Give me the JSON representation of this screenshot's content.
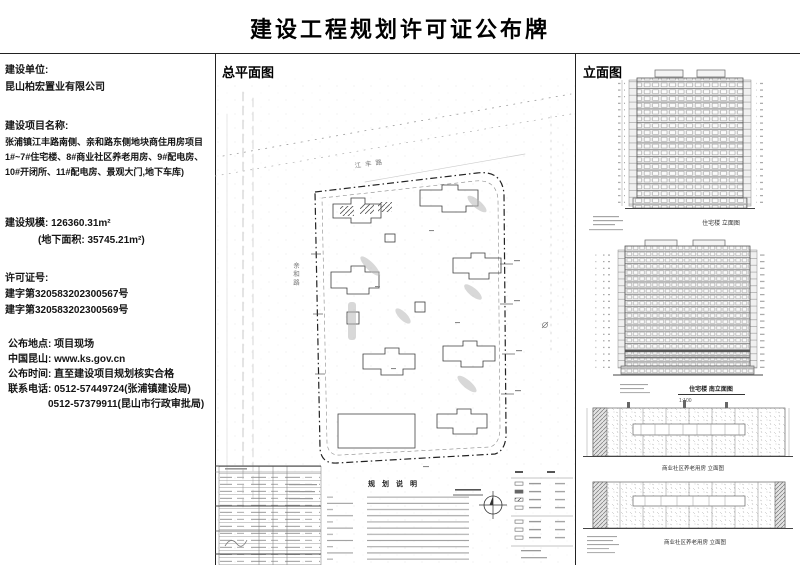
{
  "title": "建设工程规划许可证公布牌",
  "info": {
    "unit_label": "建设单位:",
    "unit_value": "昆山柏宏置业有限公司",
    "project_label": "建设项目名称:",
    "project_line1": "张浦镇江丰路南侧、亲和路东侧地块商住用房项目",
    "project_line2": "1#~7#住宅楼、8#商业社区养老用房、9#配电房、",
    "project_line3": "10#开闭所、11#配电房、景观大门,地下车库)",
    "scale_label": "建设规模:",
    "scale_value": "126360.31m²",
    "scale_sub": "(地下面积: 35745.21m²)",
    "permit_label": "许可证号:",
    "permit_no1": "建字第320583202300567号",
    "permit_no2": "建字第320583202300569号",
    "place_label": "公布地点:",
    "place_value": "项目现场",
    "site_label": "中国昆山:",
    "site_value": "www.ks.gov.cn",
    "time_label": "公布时间:",
    "time_value": "直至建设项目规划核实合格",
    "phone_label": "联系电话:",
    "phone1": "0512-57449724(张浦镇建设局)",
    "phone2": "0512-57379911(昆山市行政审批局)"
  },
  "site_plan": {
    "heading": "总平面图",
    "road_top_label": "江丰路",
    "road_left_label": "亲和路",
    "notes_title": "规划说明"
  },
  "elevations": {
    "heading": "立面图",
    "tower1_caption": "住宅楼 立面图",
    "tower2_caption": "住宅楼 南立面图",
    "tower2_scale": "1:100",
    "low1_caption": "商业社区养老用房 立面图",
    "low2_caption": "商业社区养老用房 立面图"
  }
}
